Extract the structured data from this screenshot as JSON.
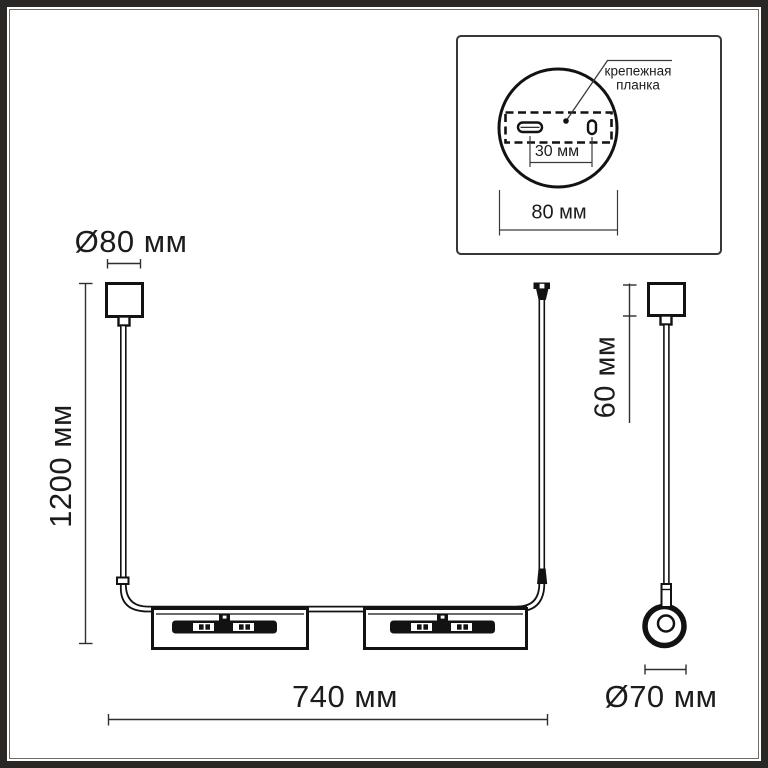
{
  "dimensions": {
    "canopy_diameter": "Ø80 мм",
    "suspension_height": "1200 мм",
    "canopy_height": "60 мм",
    "fixture_width": "740 мм",
    "end_ring_diameter": "Ø70 мм"
  },
  "inset": {
    "label_line1": "крепежная",
    "label_line2": "планка",
    "slot_spacing": "30 мм",
    "plate_width": "80 мм"
  },
  "colors": {
    "line": "#121212",
    "dimension_line": "#2f2f2f",
    "frame": "#2b2724",
    "inset_border": "#373737",
    "background": "#ffffff"
  }
}
